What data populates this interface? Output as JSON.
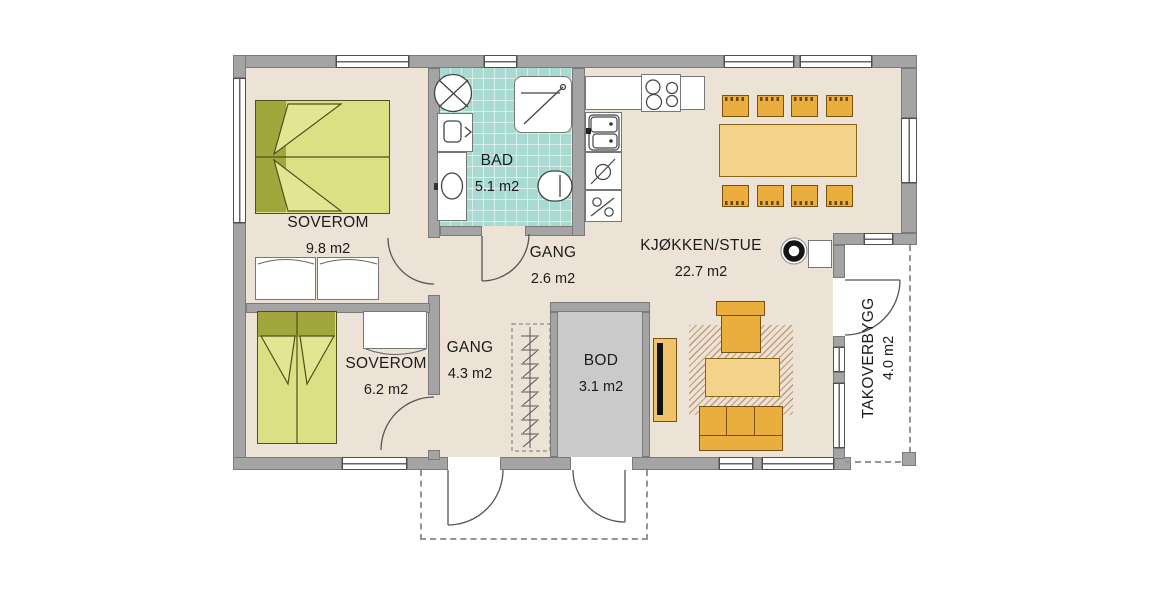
{
  "plan": {
    "rooms": [
      {
        "name": "SOVEROM",
        "area": "9.8 m2"
      },
      {
        "name": "BAD",
        "area": "5.1 m2"
      },
      {
        "name": "GANG",
        "area": "2.6 m2"
      },
      {
        "name": "KJØKKEN/STUE",
        "area": "22.7 m2"
      },
      {
        "name": "SOVEROM",
        "area": "6.2 m2"
      },
      {
        "name": "GANG",
        "area": "4.3 m2"
      },
      {
        "name": "BOD",
        "area": "3.1 m2"
      },
      {
        "name": "TAKOVERBYGG",
        "area": "4.0 m2"
      }
    ],
    "colors": {
      "wall": "#a4a4a4",
      "floor": "#ede2d6",
      "bathroom_tile": "#a9dad2",
      "bod_floor": "#cacaca",
      "bed_dark": "#a2a73d",
      "bed_light": "#dce084",
      "furniture_amber": "#e9ae3e",
      "table_amber_light": "#f3d38a",
      "line": "#4a4a4a"
    }
  }
}
